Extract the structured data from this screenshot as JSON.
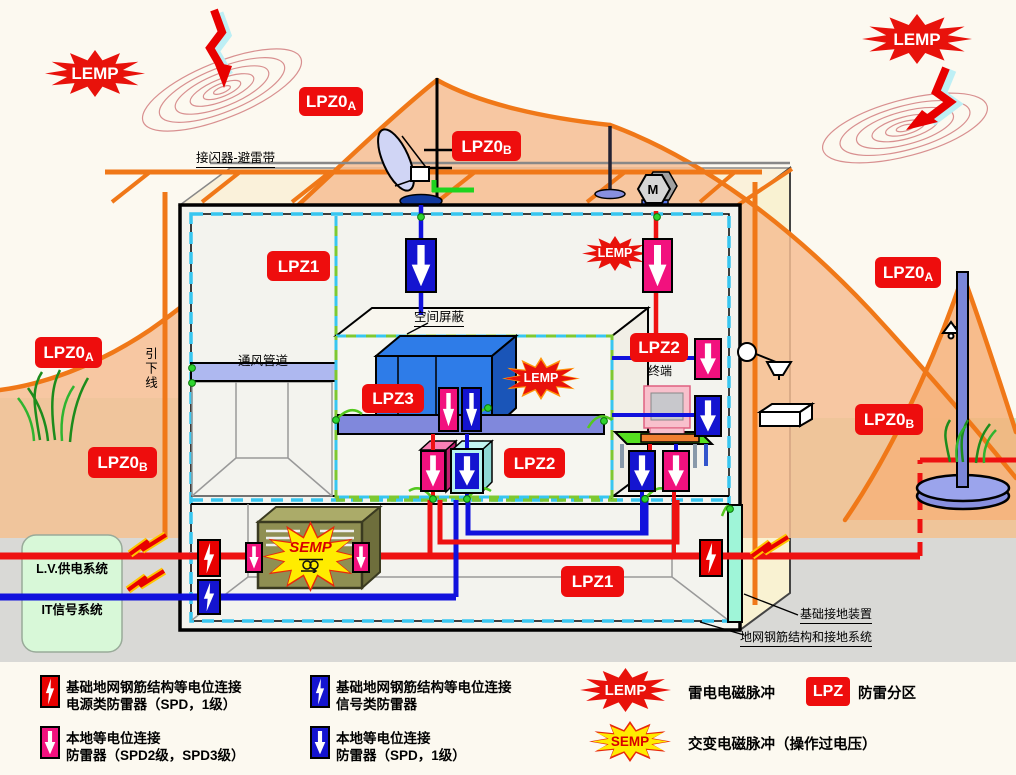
{
  "zones": {
    "lpz0_prefix": "LPZ0",
    "sub_a": "A",
    "sub_b": "B",
    "lpz1": "LPZ1",
    "lpz2": "LPZ2",
    "lpz3": "LPZ3"
  },
  "bursts": {
    "lemp": "LEMP",
    "semp": "SEMP"
  },
  "equipment_labels": {
    "motor": "M"
  },
  "annotations": {
    "air_terminal": "接闪器-避雷带",
    "space_shield": "空间屏蔽",
    "vent_duct": "通风管道",
    "down_conductor": "引下线",
    "terminal": "终端",
    "lv_power_system": "L.V.供电系统",
    "it_signal_system": "IT信号系统",
    "foundation_ground": "基础接地装置",
    "ground_grid_system": "地网钢筋结构和接地系统"
  },
  "legend": {
    "items": [
      {
        "icon": "spd-power-red-bolt",
        "line1": "基础地网钢筋结构等电位连接",
        "line2": "电源类防雷器（SPD，1级）"
      },
      {
        "icon": "spd-signal-blue-bolt",
        "line1": "基础地网钢筋结构等电位连接",
        "line2": "信号类防雷器"
      },
      {
        "icon": "spd-local-pink-arrow",
        "line1": "本地等电位连接",
        "line2": "防雷器（SPD2级，SPD3级）"
      },
      {
        "icon": "spd-local-blue-arrow",
        "line1": "本地等电位连接",
        "line2": "防雷器（SPD，1级）"
      },
      {
        "icon": "lemp-burst",
        "label": "LEMP",
        "desc": "雷电电磁脉冲"
      },
      {
        "icon": "lpz-badge",
        "label": "LPZ",
        "desc": "防雷分区"
      },
      {
        "icon": "semp-burst",
        "label": "SEMP",
        "desc": "交变电磁脉冲（操作过电压）"
      }
    ]
  },
  "colors": {
    "zone_badge_red": "#EE0D0D",
    "burst_red": "#E8120B",
    "semp_yellow": "#FFEC00",
    "spd_pink": "#F2117E",
    "spd_blue": "#1414D0",
    "spd_red": "#E80000",
    "shield_cyan": "#38C6F0",
    "bond_green": "#7DC832",
    "lpz0_cone_orange": "#F07818",
    "power_line_red": "#EE1111",
    "signal_line_blue": "#1111DD"
  }
}
